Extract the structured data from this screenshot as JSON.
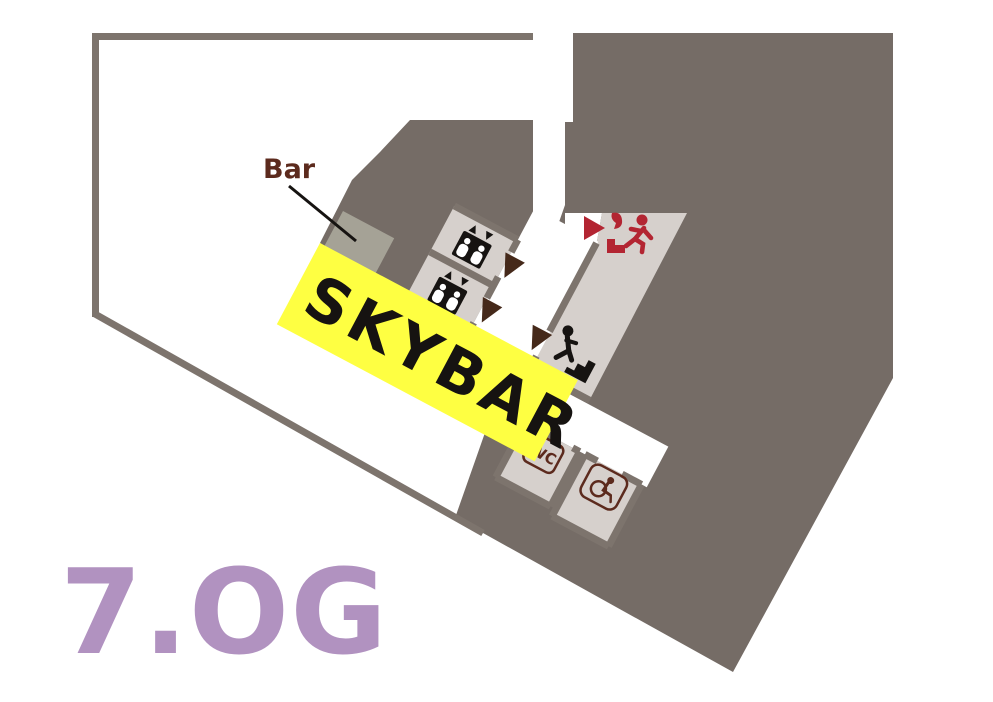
{
  "floorplan": {
    "floor_label": "7.OG",
    "area_label": "SKYBAR",
    "bar_label": "Bar",
    "wc_label": "WC",
    "icons": {
      "elevator": "elevator-icon",
      "stairs": "stairs-icon",
      "emergency_exit": "emergency-exit-icon",
      "wheelchair": "accessible-wc-icon",
      "direction_arrows": "direction-arrow-icon",
      "exit_arrow": "exit-arrow-icon"
    },
    "colors": {
      "wall_mass": "#756c66",
      "wall_stroke": "#7d746d",
      "room_fill": "#d6d0cc",
      "highlight_yellow": "#feff42",
      "accent_red": "#b32532",
      "arrow_brown": "#45291a",
      "label_brown": "#5c2a1d",
      "floor_label_purple": "#b192c0",
      "bar_counter": "#a5a296",
      "ink": "#161311",
      "background": "#ffffff"
    }
  }
}
